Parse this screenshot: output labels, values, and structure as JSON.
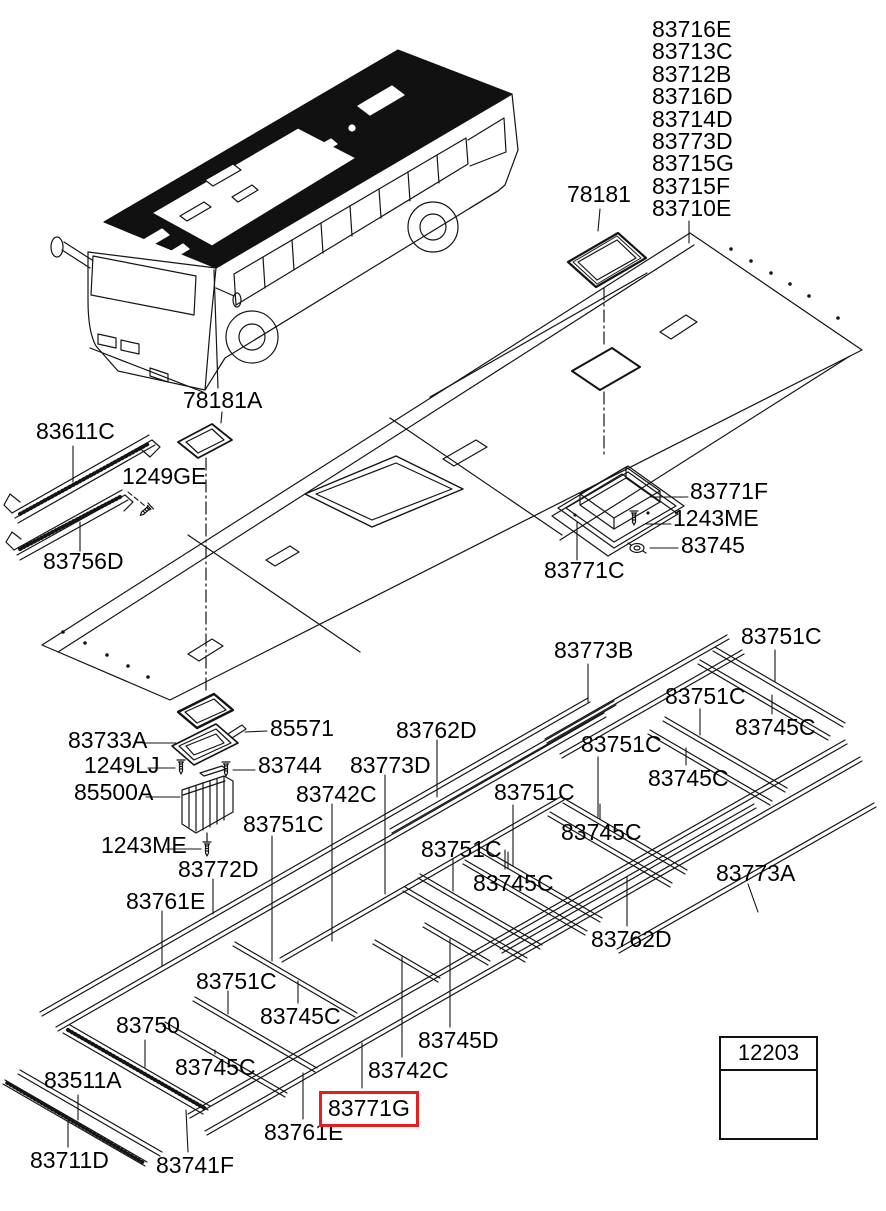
{
  "colors": {
    "highlight": "#e61e1e",
    "line": "#141414",
    "background": "#ffffff"
  },
  "selected_part": "83771G",
  "part_list": [
    "83716E",
    "83713C",
    "83712B",
    "83716D",
    "83714D",
    "83773D",
    "83715G",
    "83715F",
    "83710E"
  ],
  "legend": {
    "part_number": "12203",
    "icon": "screw-icon"
  },
  "labels": [
    {
      "text": "78181",
      "x": 567,
      "y": 183
    },
    {
      "text": "78181A",
      "x": 183,
      "y": 389
    },
    {
      "text": "83611C",
      "x": 36,
      "y": 420
    },
    {
      "text": "1249GE",
      "x": 122,
      "y": 465
    },
    {
      "text": "83756D",
      "x": 43,
      "y": 550
    },
    {
      "text": "83771F",
      "x": 690,
      "y": 480
    },
    {
      "text": "1243ME",
      "x": 673,
      "y": 507
    },
    {
      "text": "83745",
      "x": 681,
      "y": 534
    },
    {
      "text": "83771C",
      "x": 544,
      "y": 559
    },
    {
      "text": "83733A",
      "x": 68,
      "y": 729
    },
    {
      "text": "85571",
      "x": 270,
      "y": 717
    },
    {
      "text": "1249LJ",
      "x": 84,
      "y": 754
    },
    {
      "text": "83744",
      "x": 258,
      "y": 754
    },
    {
      "text": "85500A",
      "x": 74,
      "y": 781
    },
    {
      "text": "1243ME",
      "x": 101,
      "y": 834
    },
    {
      "text": "83773B",
      "x": 554,
      "y": 639
    },
    {
      "text": "83751C",
      "x": 741,
      "y": 625
    },
    {
      "text": "83751C",
      "x": 665,
      "y": 685
    },
    {
      "text": "83745C",
      "x": 735,
      "y": 716
    },
    {
      "text": "83751C",
      "x": 581,
      "y": 733
    },
    {
      "text": "83745C",
      "x": 648,
      "y": 767
    },
    {
      "text": "83751C",
      "x": 494,
      "y": 781
    },
    {
      "text": "83745C",
      "x": 561,
      "y": 821
    },
    {
      "text": "83751C",
      "x": 421,
      "y": 838
    },
    {
      "text": "83745C",
      "x": 473,
      "y": 872
    },
    {
      "text": "83773A",
      "x": 716,
      "y": 862
    },
    {
      "text": "83762D",
      "x": 591,
      "y": 928
    },
    {
      "text": "83762D",
      "x": 396,
      "y": 719
    },
    {
      "text": "83773D",
      "x": 350,
      "y": 754
    },
    {
      "text": "83742C",
      "x": 296,
      "y": 783
    },
    {
      "text": "83751C",
      "x": 243,
      "y": 813
    },
    {
      "text": "83772D",
      "x": 178,
      "y": 858
    },
    {
      "text": "83761E",
      "x": 126,
      "y": 890
    },
    {
      "text": "83751C",
      "x": 196,
      "y": 970
    },
    {
      "text": "83745C",
      "x": 260,
      "y": 1005
    },
    {
      "text": "83750",
      "x": 116,
      "y": 1014
    },
    {
      "text": "83745C",
      "x": 175,
      "y": 1056
    },
    {
      "text": "83511A",
      "x": 44,
      "y": 1069
    },
    {
      "text": "83711D",
      "x": 30,
      "y": 1149
    },
    {
      "text": "83741F",
      "x": 156,
      "y": 1154
    },
    {
      "text": "83761E",
      "x": 264,
      "y": 1121
    },
    {
      "text": "83745D",
      "x": 418,
      "y": 1029
    },
    {
      "text": "83742C",
      "x": 368,
      "y": 1059
    },
    {
      "text": "83771G",
      "x": 319,
      "y": 1091,
      "boxed": true
    }
  ]
}
